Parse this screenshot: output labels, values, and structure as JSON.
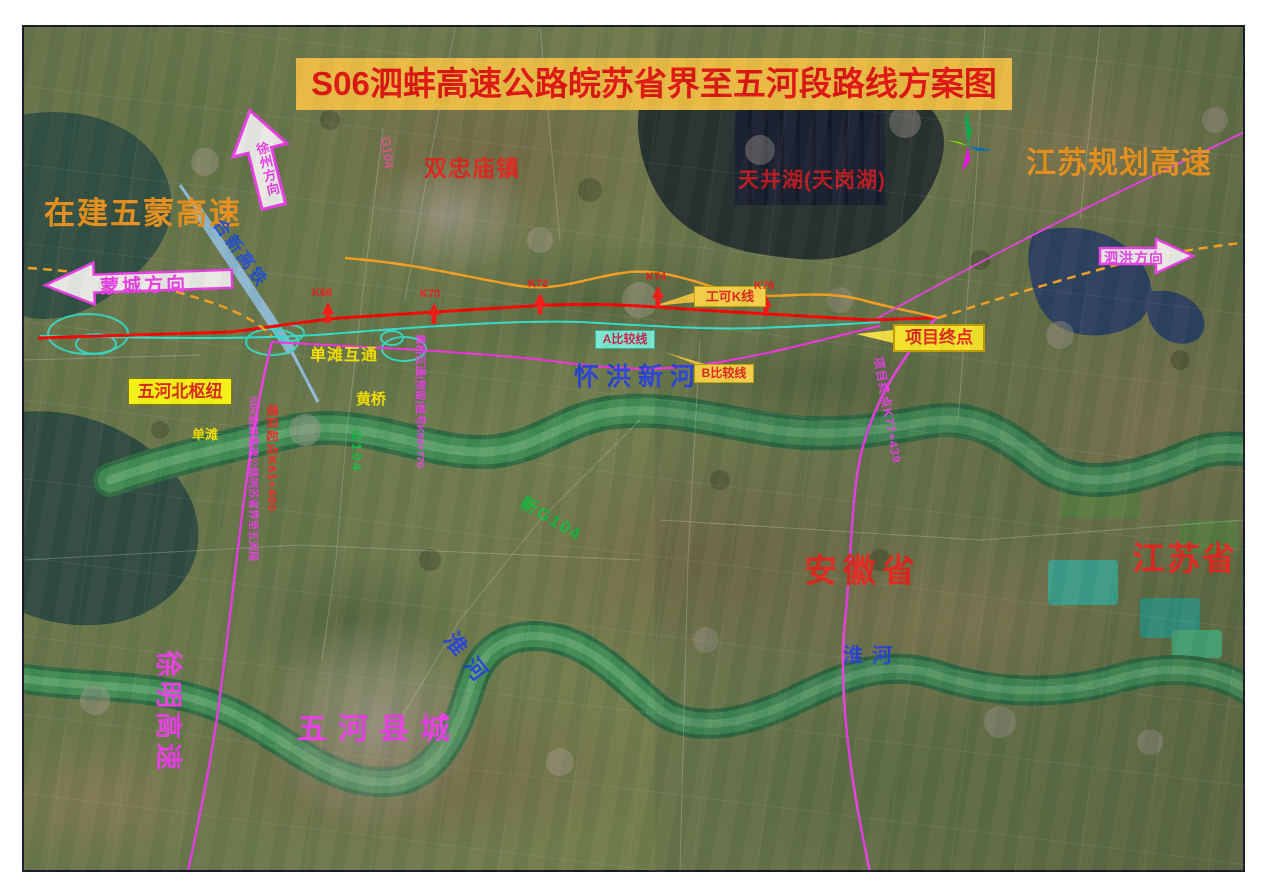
{
  "map": {
    "title": "S06泗蚌高速公路皖苏省界至五河段路线方案图",
    "regions": {
      "anhui": "安徽省",
      "jiangsu": "江苏省"
    },
    "roads": {
      "wumeng": "在建五蒙高速",
      "jiangsu_planned": "江苏规划高速",
      "xuming": "徐明高速",
      "g104_north": "G104",
      "g104_mid": "G104",
      "new_g104": "新G104",
      "hexin_railway": "合新高铁"
    },
    "waters": {
      "tianjing_lake": "天井湖(天岗湖)",
      "huaihong_river": "怀洪新河",
      "huai_river_west": "淮河",
      "huai_river_east": "淮河"
    },
    "places": {
      "shuangzhongmiao": "双忠庙镇",
      "wuhe_county": "五河县城",
      "dantan": "单滩",
      "huangqiao": "黄桥"
    },
    "direction_arrows": {
      "xuzhou": "徐州方向",
      "mengcheng": "蒙城方向",
      "sihong": "泗洪方向"
    },
    "callouts": {
      "wuhe_north_hub": "五河北枢纽",
      "feasibility_k_line": "工可K线",
      "comparison_line_a": "A比较线",
      "comparison_line_b": "B比较线",
      "project_end": "项目终点"
    },
    "route_notes": {
      "dantan_interchange": "单滩互通",
      "huangqiao_interchange": "黄桥互通(预留)桩号K69+770",
      "s06_section": "S06泗蚌高速公路皖苏省界至五河段",
      "project_start_stake": "项目起点K61+400",
      "project_end_stake": "项目终点K77+439"
    },
    "km_markers": [
      "K68",
      "K70",
      "K72",
      "K74",
      "K76"
    ],
    "colors": {
      "title_bg": "#f4c145",
      "title_text": "#e81010",
      "k_line_red": "#ff0000",
      "comparison_a_cyan": "#2fe8d8",
      "comparison_b_magenta": "#ff2ff2",
      "feasibility_orange": "#ffa420",
      "railway_blue": "#93c4ea",
      "label_orange": "#f0941c",
      "label_yellow": "#ffe800",
      "label_green": "#10c040",
      "label_blue": "#2441e0",
      "label_magenta": "#f23cf2"
    }
  }
}
